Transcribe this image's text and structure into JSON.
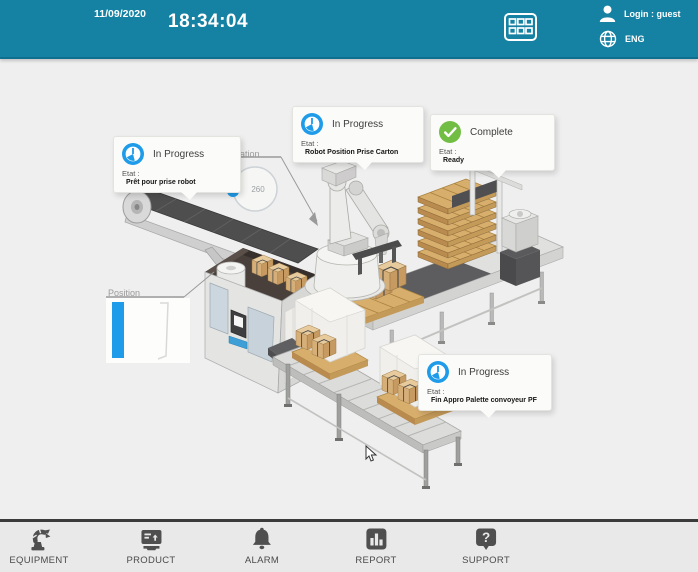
{
  "colors": {
    "header_bg": "#1581A3",
    "accent_blue": "#1E9BE9",
    "success_green": "#72BE44",
    "body_bg": "#EFEFEF",
    "nav_icon_gray": "#4F4F4F"
  },
  "header": {
    "date": "11/09/2020",
    "time": "18:34:04",
    "login": "Login : guest",
    "language": "ENG"
  },
  "callouts": [
    {
      "status": "In Progress",
      "icon": "clock",
      "etat_label": "Etat :",
      "etat_value": "Prêt pour prise robot"
    },
    {
      "status": "In Progress",
      "icon": "clock",
      "etat_label": "Etat :",
      "etat_value": "Robot Position Prise Carton"
    },
    {
      "status": "Complete",
      "icon": "check",
      "etat_label": "Etat :",
      "etat_value": "Ready"
    },
    {
      "status": "In Progress",
      "icon": "clock",
      "etat_label": "Etat :",
      "etat_value": "Fin Appro Palette convoyeur PF"
    }
  ],
  "widgets": {
    "rotation": {
      "label": "Rotation",
      "value": "260"
    },
    "position": {
      "label": "Position"
    }
  },
  "nav": {
    "items": [
      {
        "label": "EQUIPMENT",
        "icon": "robot-arm"
      },
      {
        "label": "PRODUCT",
        "icon": "machine"
      },
      {
        "label": "ALARM",
        "icon": "bell"
      },
      {
        "label": "REPORT",
        "icon": "bar-chart"
      },
      {
        "label": "SUPPORT",
        "icon": "question-bubble"
      }
    ]
  }
}
